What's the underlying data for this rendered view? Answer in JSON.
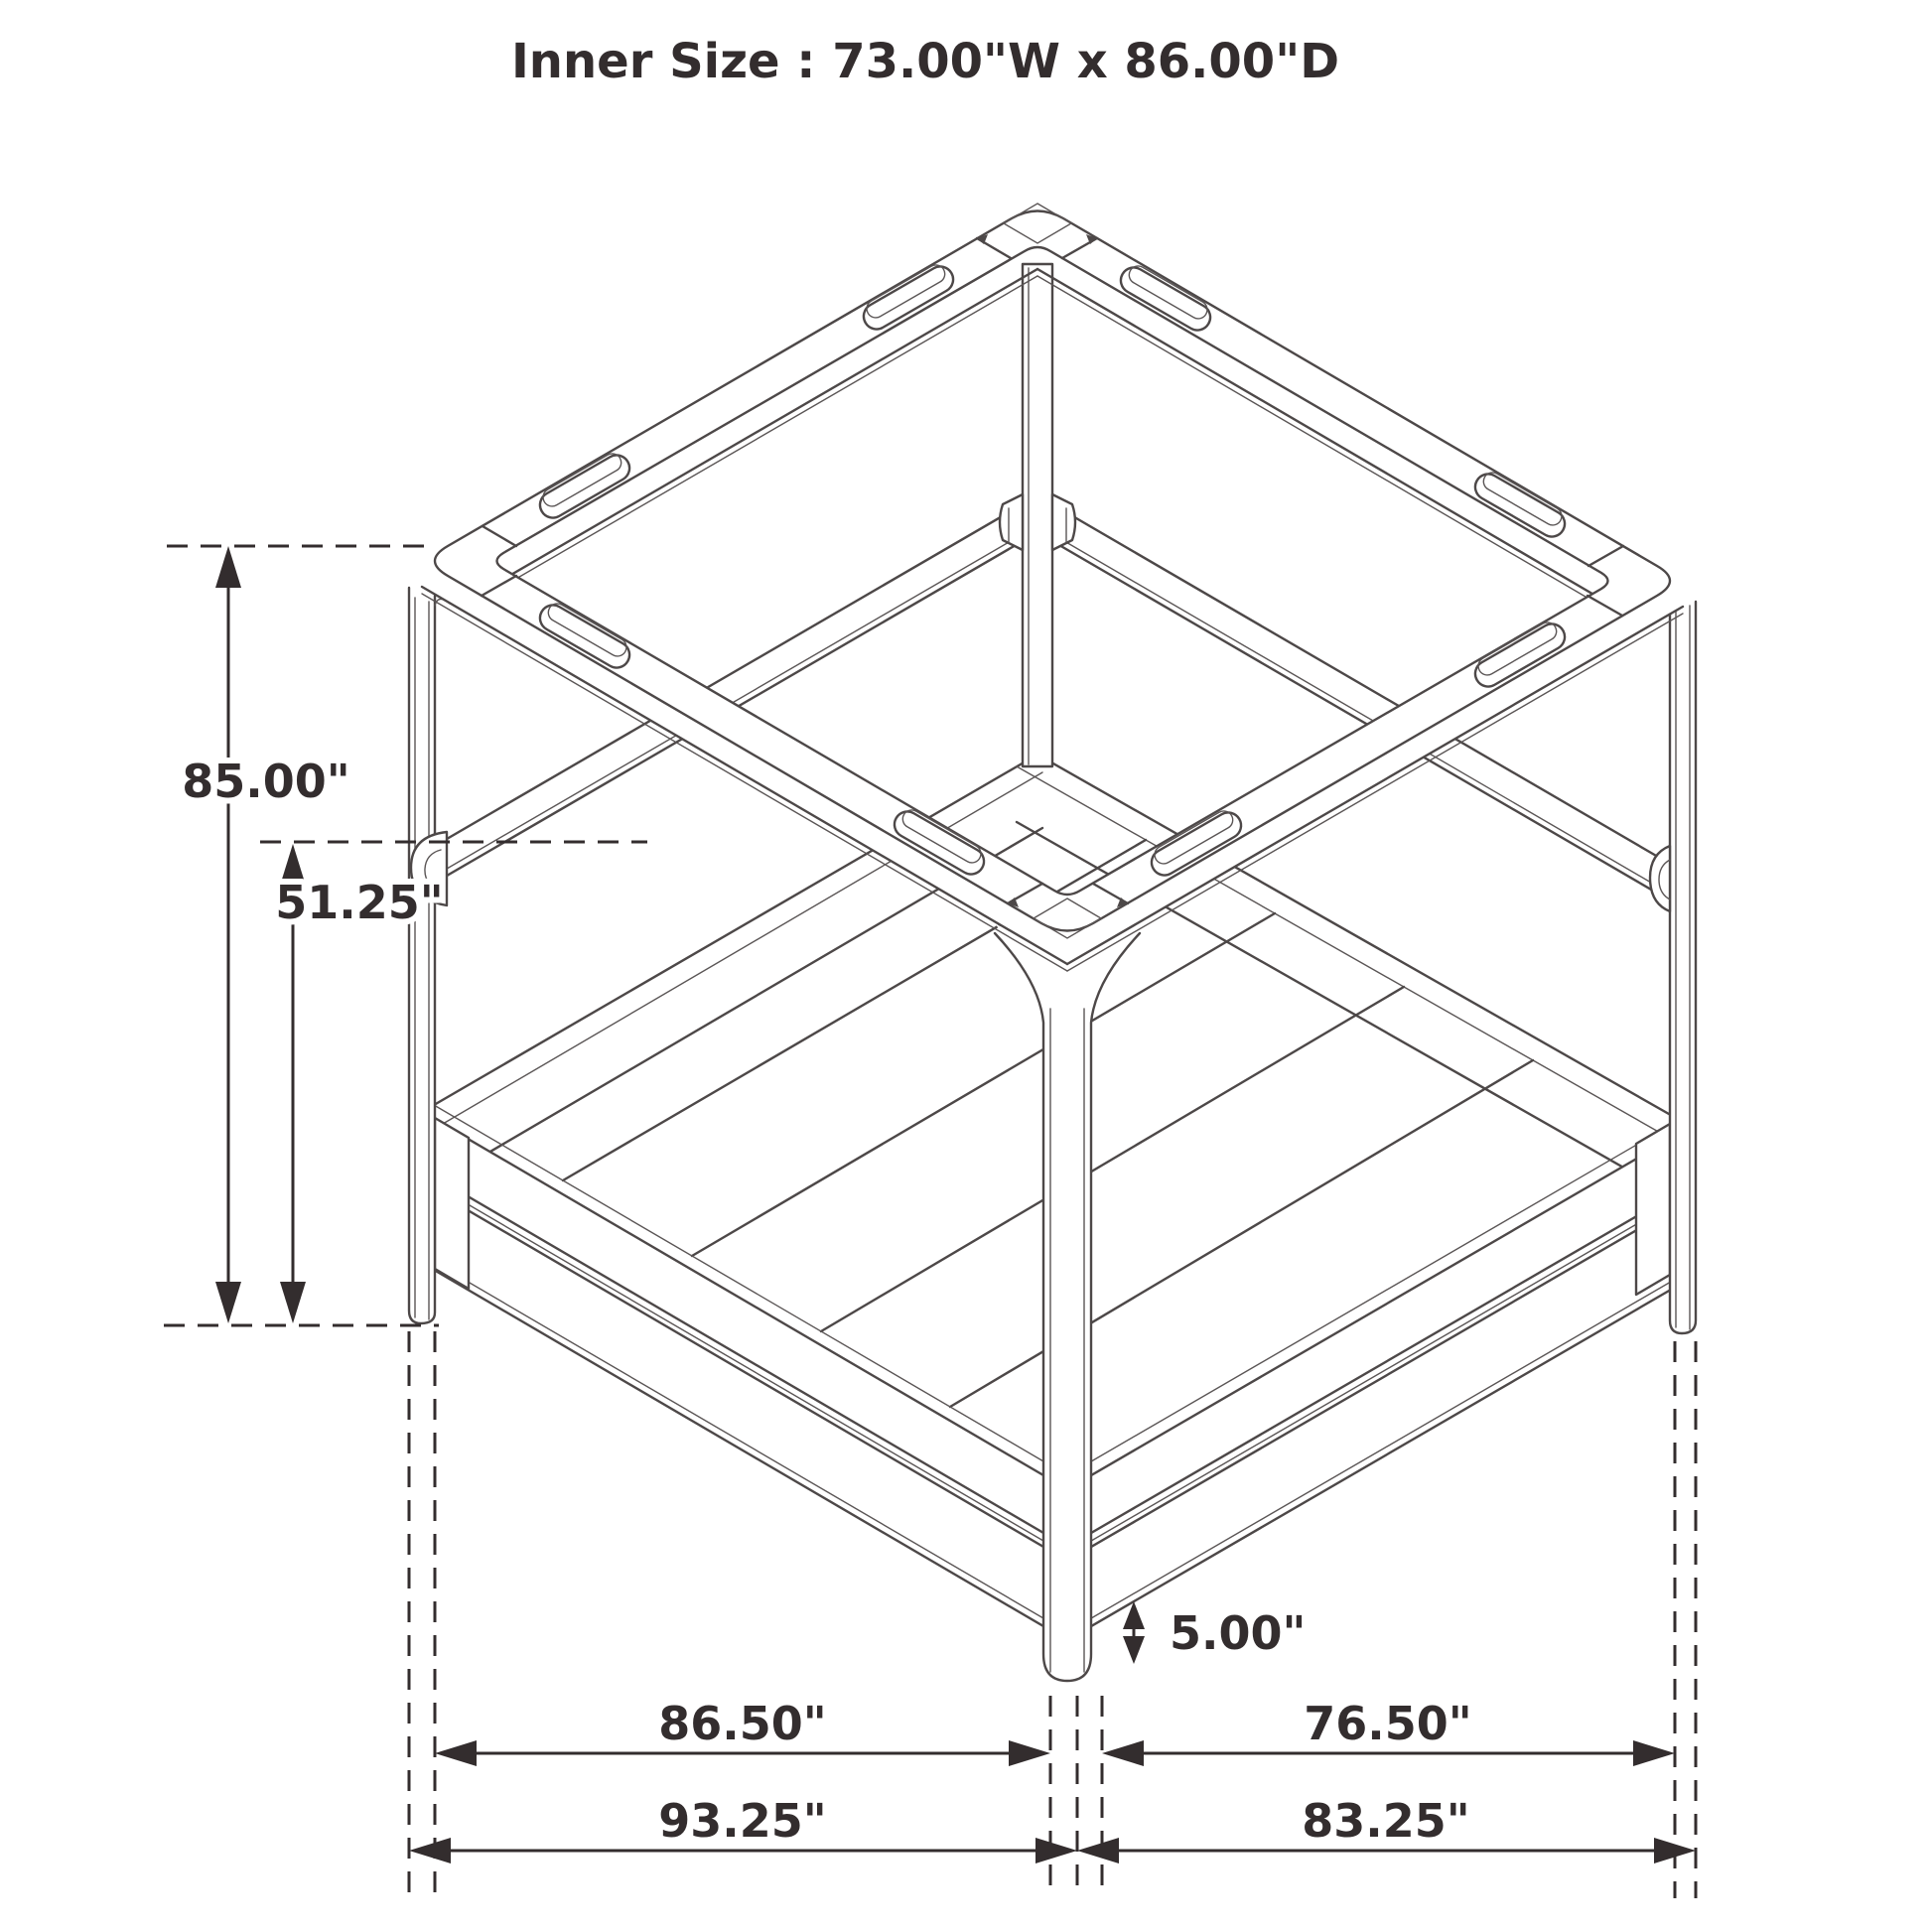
{
  "title": "Inner Size : 73.00\"W x 86.00\"D",
  "figure": {
    "type": "isometric-line-drawing",
    "subject": "canopy-bed-frame",
    "features": [
      "canopy top frame with oblong slots",
      "four corner posts",
      "mid-height side rails with hook brackets",
      "slatted platform base",
      "dimension arrows with dashed projection lines"
    ]
  },
  "dimensions": {
    "overall_height": "85.00\"",
    "rail_height": "51.25\"",
    "base_clearance": "5.00\"",
    "side_inner_left": "86.50\"",
    "side_inner_right": "76.50\"",
    "side_overall_left": "93.25\"",
    "side_overall_right": "83.25\""
  },
  "colors": {
    "background": "#ffffff",
    "drawing_line": "#4d4848",
    "annotation": "#332d2e"
  }
}
